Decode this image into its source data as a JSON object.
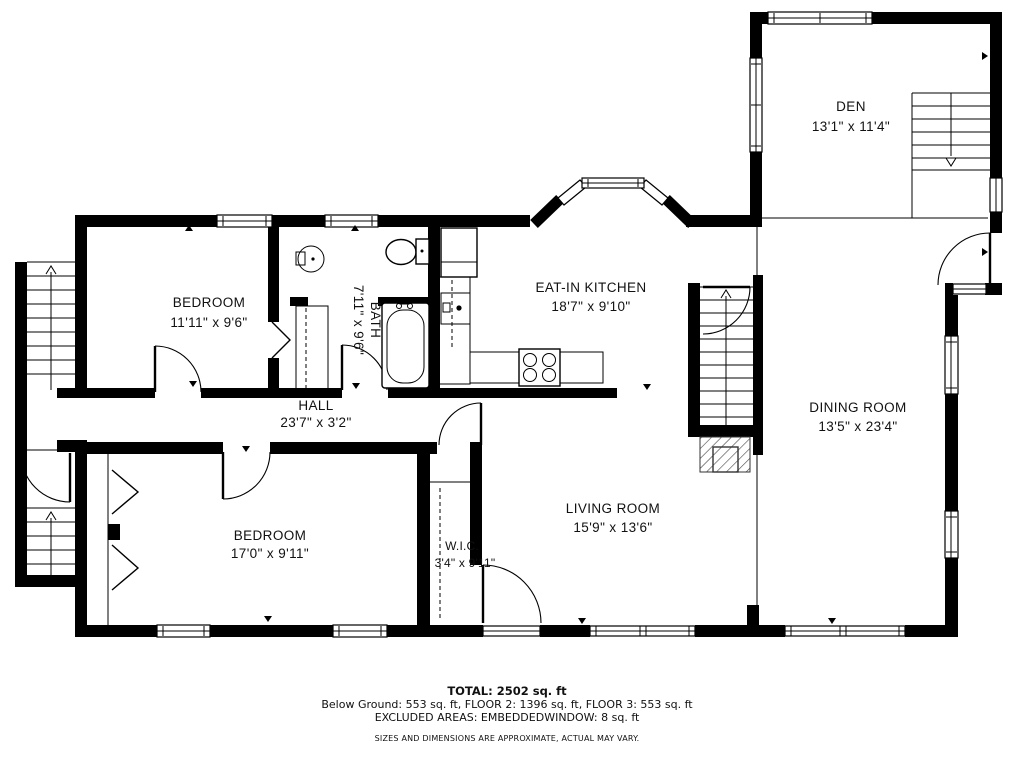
{
  "rooms": {
    "den": {
      "name": "DEN",
      "dims": "13'1\" x 11'4\""
    },
    "bedroom1": {
      "name": "BEDROOM",
      "dims": "11'11\" x 9'6\""
    },
    "bath": {
      "name": "BATH",
      "dims": "7'11\" x 9'6\""
    },
    "kitchen": {
      "name": "EAT-IN KITCHEN",
      "dims": "18'7\" x 9'10\""
    },
    "dining": {
      "name": "DINING ROOM",
      "dims": "13'5\" x 23'4\""
    },
    "hall": {
      "name": "HALL",
      "dims": "23'7\" x 3'2\""
    },
    "bedroom2": {
      "name": "BEDROOM",
      "dims": "17'0\" x 9'11\""
    },
    "wic": {
      "name": "W.I.C.",
      "dims": "3'4\" x 9'11\""
    },
    "living": {
      "name": "LIVING ROOM",
      "dims": "15'9\" x 13'6\""
    }
  },
  "summary": {
    "total": "TOTAL: 2502 sq. ft",
    "floors": "Below Ground: 553 sq. ft, FLOOR 2: 1396 sq. ft, FLOOR 3: 553 sq. ft",
    "excluded": "EXCLUDED AREAS: EMBEDDEDWINDOW: 8 sq. ft",
    "disclaimer": "SIZES AND DIMENSIONS ARE APPROXIMATE, ACTUAL MAY VARY."
  },
  "colors": {
    "wall": "#000000",
    "background": "#ffffff",
    "text": "#111111"
  }
}
